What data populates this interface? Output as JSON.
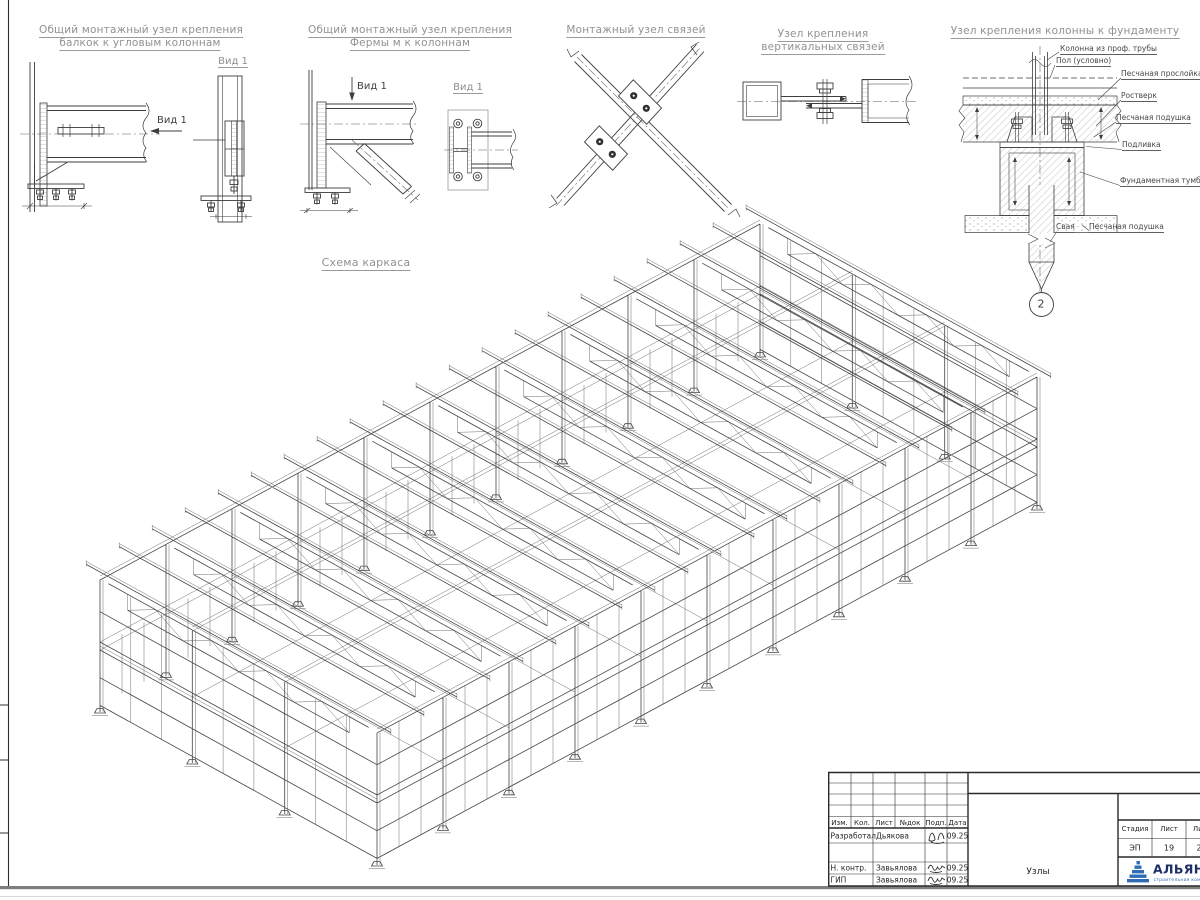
{
  "view_label": "Вид 1",
  "details": {
    "d1": {
      "title1": "Общий монтажный узел крепления",
      "title2": "балкок к угловым колоннам"
    },
    "d2": {
      "title1": "Общий монтажный узел крепления",
      "title2": "Фермы м к колоннам"
    },
    "d3": {
      "title": "Монтажный узел связей"
    },
    "d4": {
      "title1": "Узел крепления",
      "title2": "вертикальных связей"
    },
    "d5": {
      "title": "Узел крепления колонны к фундаменту",
      "labels": {
        "column": "Колонна из проф. трубы",
        "floor": "Пол (условно)",
        "sand_layer": "Песчаная прослойка",
        "grillage": "Ростверк",
        "sand_cushion": "Песчаная подушка",
        "grout": "Подливка",
        "pedestal": "Фундаментная тумба",
        "pile": "Свая",
        "sand_cushion2": "Песчаная подушка"
      },
      "marker": "2"
    }
  },
  "scheme": {
    "title": "Схема каркаса"
  },
  "titleblock": {
    "cols": {
      "izm": "Изм.",
      "kol": "Кол.",
      "list": "Лист",
      "ndok": "№док",
      "podp": "Подп.",
      "data": "Дата"
    },
    "rows": {
      "developed_role": "Разработал",
      "developed_name": "Дьякова",
      "developed_date": "09.25",
      "ncontr_role": "Н. контр.",
      "ncontr_name": "Завьялова",
      "ncontr_date": "09.25",
      "gip_role": "ГИП",
      "gip_name": "Завьялова",
      "gip_date": "09.25"
    },
    "stage_label": "Стадия",
    "sheet_label": "Лист",
    "sheets_label": "Листов",
    "stage": "ЭП",
    "sheet": "19",
    "sheets": "2",
    "doc_name": "Узлы",
    "company": "АЛЬЯНС",
    "company_sub": "строительная компания"
  },
  "colors": {
    "accent_blue": "#2e6cb5",
    "navy": "#1d2f66",
    "line": "#3d3d3d",
    "gray_text": "#919191"
  }
}
